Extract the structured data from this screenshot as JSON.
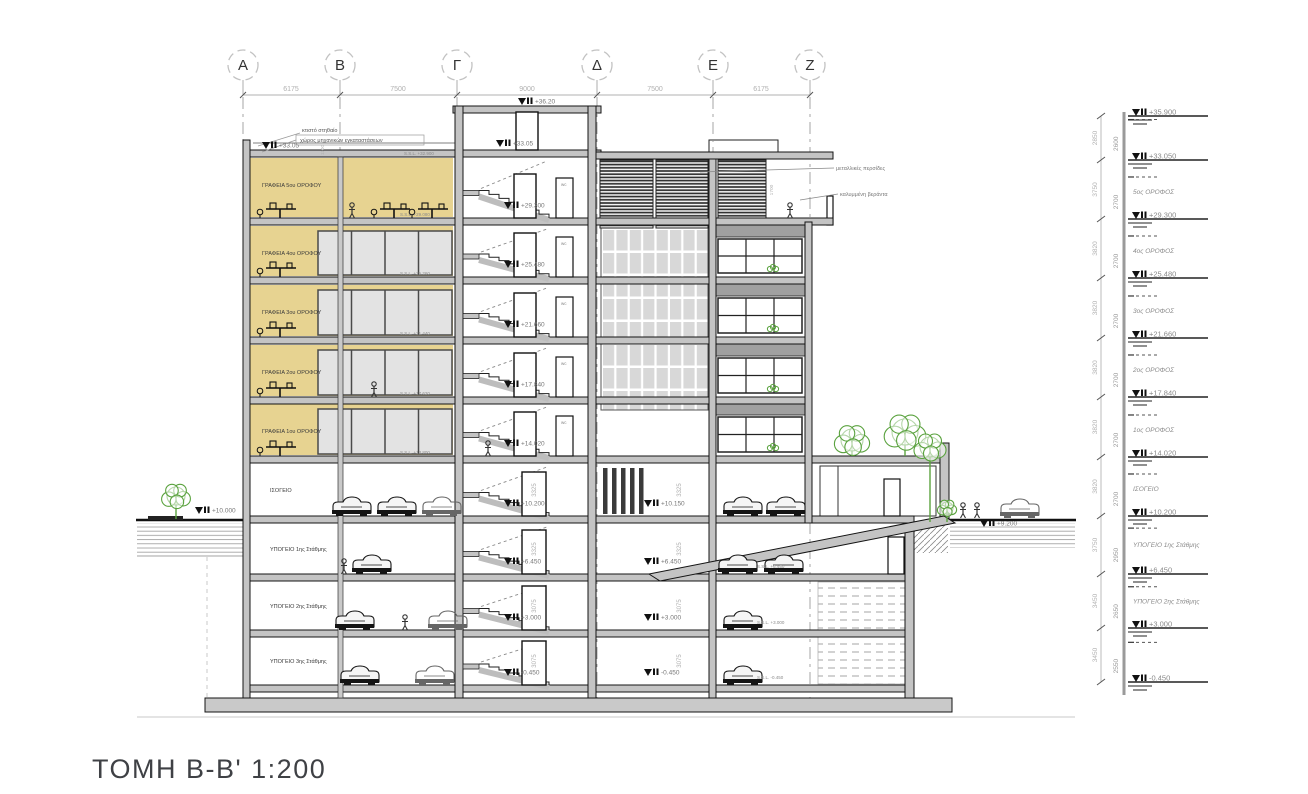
{
  "title": {
    "text": "ΤΟΜΗ Β-Β' 1:200"
  },
  "grid": {
    "bubbles": [
      {
        "label": "Α"
      },
      {
        "label": "Β"
      },
      {
        "label": "Γ"
      },
      {
        "label": "Δ"
      },
      {
        "label": "Ε"
      },
      {
        "label": "Ζ"
      }
    ],
    "spans": [
      "6175",
      "7500",
      "9000",
      "7500",
      "6175"
    ]
  },
  "annotations": {
    "parapet_note": "κτιστό στηθαίο",
    "mech_note": "χώρος μηχανικών εγκαταστάσεων",
    "parapet_height": "1100",
    "roof_ssl": "S.S.L. +32.900",
    "roof_level": "+33.05",
    "stair_top_level": "+36.20",
    "louvers_note": "μεταλλικές περσίδες",
    "veranda_note": "καλυμμένη βεράντα",
    "louver_height": "1700",
    "wc_tag": "wc"
  },
  "office_floors": [
    {
      "label": "ΓΡΑΦΕΙΑ 5ου ΟΡΟΦΟΥ",
      "ssl": "S.S.L. +29.080"
    },
    {
      "label": "ΓΡΑΦΕΙΑ 4ου ΟΡΟΦΟΥ",
      "ssl": "S.S.L. +25.260"
    },
    {
      "label": "ΓΡΑΦΕΙΑ 3ου ΟΡΟΦΟΥ",
      "ssl": "S.S.L. +21.440"
    },
    {
      "label": "ΓΡΑΦΕΙΑ 2ου ΟΡΟΦΟΥ",
      "ssl": "S.S.L. +17.620"
    },
    {
      "label": "ΓΡΑΦΕΙΑ 1ου ΟΡΟΦΟΥ",
      "ssl": "S.S.L. +13.800"
    }
  ],
  "lower_floors": [
    {
      "label": "ΙΣΟΓΕΙΟ",
      "clear_height": "3325"
    },
    {
      "label": "ΥΠΟΓΕΙΟ 1ης Στάθμης",
      "clear_height": "3325"
    },
    {
      "label": "ΥΠΟΓΕΙΟ 2ης Στάθμης",
      "clear_height": "3075"
    },
    {
      "label": "ΥΠΟΓΕΙΟ 3ης Στάθμης",
      "clear_height": "3075"
    }
  ],
  "core_levels": [
    "+36.20",
    "+33.05",
    "+29.300",
    "+25.480",
    "+21.660",
    "+17.840",
    "+14.020",
    "+10.200",
    "+6.450",
    "+3.000",
    "-0.450"
  ],
  "mid_levels": [
    "+10.150",
    "+6.450",
    "+3.000",
    "-0.450"
  ],
  "right_ssl": [
    "S.S.L. +6.450",
    "S.S.L. +3.000",
    "S.S.L. -0.450"
  ],
  "site_levels": {
    "left_street": "+10.000",
    "right_street": "+9.200"
  },
  "level_scale": {
    "entries": [
      {
        "elevation": "+35.900",
        "storey_height": "2850",
        "clear_height": "2600",
        "label": ""
      },
      {
        "elevation": "+33.050",
        "storey_height": "3750",
        "clear_height": "2700",
        "label": "5ος ΟΡΟΦΟΣ"
      },
      {
        "elevation": "+29.300",
        "storey_height": "3820",
        "clear_height": "2700",
        "label": "4ος ΟΡΟΦΟΣ"
      },
      {
        "elevation": "+25.480",
        "storey_height": "3820",
        "clear_height": "2700",
        "label": "3ος ΟΡΟΦΟΣ"
      },
      {
        "elevation": "+21.660",
        "storey_height": "3820",
        "clear_height": "2700",
        "label": "2ος ΟΡΟΦΟΣ"
      },
      {
        "elevation": "+17.840",
        "storey_height": "3820",
        "clear_height": "2700",
        "label": "1ος ΟΡΟΦΟΣ"
      },
      {
        "elevation": "+14.020",
        "storey_height": "3820",
        "clear_height": "2700",
        "label": "ΙΣΟΓΕΙΟ"
      },
      {
        "elevation": "+10.200",
        "storey_height": "3750",
        "clear_height": "2950",
        "label": "ΥΠΟΓΕΙΟ 1ης Στάθμης"
      },
      {
        "elevation": "+6.450",
        "storey_height": "3450",
        "clear_height": "2650",
        "label": "ΥΠΟΓΕΙΟ 2ης Στάθμης"
      },
      {
        "elevation": "+3.000",
        "storey_height": "3450",
        "clear_height": "2550",
        "label": ""
      },
      {
        "elevation": "-0.450",
        "storey_height": "",
        "clear_height": "",
        "label": ""
      }
    ]
  },
  "colors": {
    "office_fill": "#e7d391",
    "glass_fill": "#e3e3e3",
    "slab_fill": "#c4c4c4",
    "curtain_fill": "#d8d8d8",
    "spandrel_fill": "#a0a0a0",
    "green": "#5aa23e",
    "dim_text": "#b0b0b0",
    "level_text": "#8a8a8a",
    "line": "#141414"
  }
}
